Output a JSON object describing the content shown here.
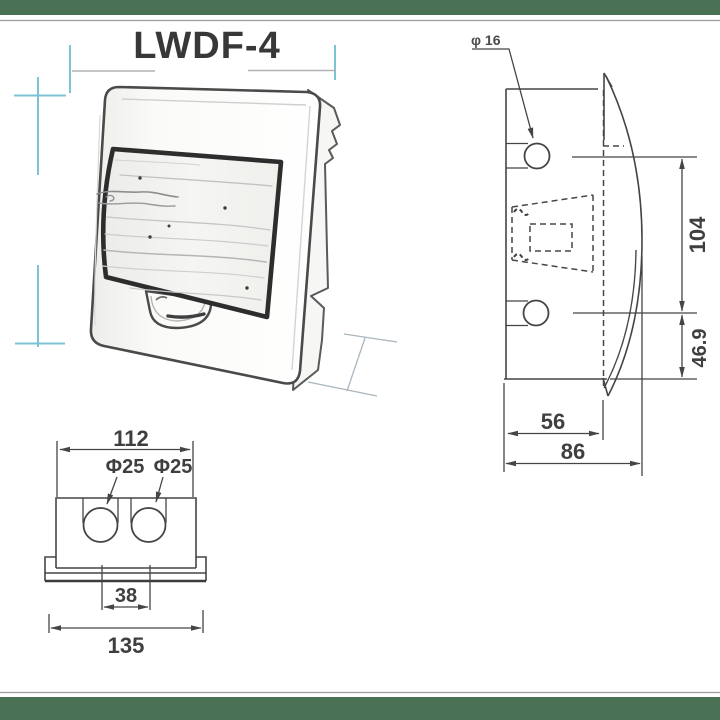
{
  "colors": {
    "accent_bar": "#4a7153",
    "guide_cyan": "#7cc3d8"
  },
  "title": "LWDF-4",
  "side_view": {
    "knockout_label": "φ 16",
    "hole_spacing_mm": "104",
    "lower_offset_mm": "46.9",
    "recess_depth_mm": "56",
    "overall_depth_mm": "86"
  },
  "bottom_view": {
    "body_width_mm": "112",
    "knockout_left_label": "Φ25",
    "knockout_right_label": "Φ25",
    "knockout_spacing_mm": "38",
    "flange_width_mm": "135"
  }
}
